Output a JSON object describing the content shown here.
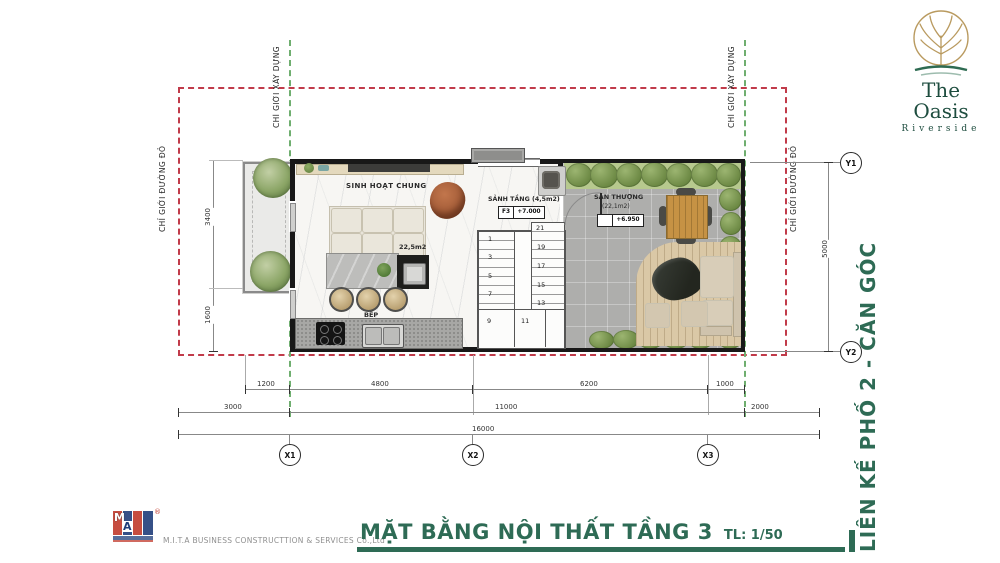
{
  "header": {
    "logo_title": "The Oasis",
    "logo_subtitle": "Riverside"
  },
  "footer": {
    "company": "M.I.T.A BUSINESS CONSTRUCTTION & SERVICES Co.,Ltd",
    "logo_m": "M",
    "logo_a": "A",
    "logo_r": "®"
  },
  "title": {
    "main": "MẶT BẰNG NỘI THẤT TẦNG 3",
    "scale": "TL: 1/50",
    "side": "LIÊN KẾ PHỐ 2 - CĂN GÓC"
  },
  "boundaries": {
    "construction": "CHỈ GIỚI XÂY DỰNG",
    "redline": "CHỈ GIỚI ĐƯỜNG ĐỎ"
  },
  "rooms": {
    "living": {
      "name": "SINH HOẠT CHUNG",
      "area": "22,5m2"
    },
    "kitchen": {
      "name": "BẾP"
    },
    "hall": {
      "name": "SẢNH TẦNG (4,5m2)",
      "level_tag": "F3",
      "level_value": "+7.000"
    },
    "terrace": {
      "name": "SÂN THƯỢNG",
      "area": "(22,1m2)",
      "level_value": "+6.950"
    }
  },
  "stairs": {
    "left": [
      "1",
      "3",
      "5",
      "7"
    ],
    "bottom": [
      "9",
      "11"
    ],
    "right": [
      "21",
      "19",
      "17",
      "15",
      "13"
    ]
  },
  "dimensions": {
    "top_row": [
      "1200",
      "4800",
      "6200",
      "1000"
    ],
    "mid_row": [
      "3000",
      "11000",
      "2000"
    ],
    "total_row": [
      "16000"
    ],
    "left_col": [
      "3400",
      "1600"
    ],
    "right_col": [
      "5000"
    ]
  },
  "grid": {
    "x": [
      "X1",
      "X2",
      "X3"
    ],
    "y": [
      "Y1",
      "Y2"
    ]
  },
  "colors": {
    "accent_green": "#2e6b55",
    "boundary_red": "#c13b4a",
    "boundary_green": "#6fae6f",
    "wall": "#181818"
  }
}
